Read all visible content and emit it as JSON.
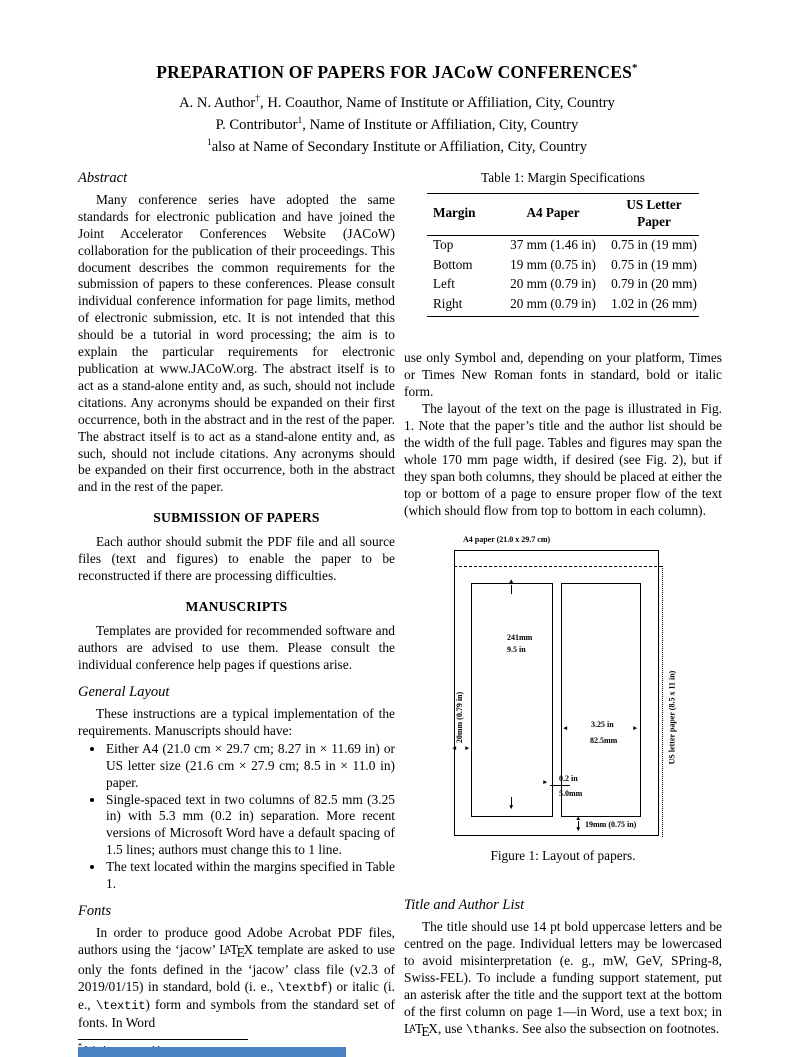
{
  "title": {
    "text": "PREPARATION OF PAPERS FOR JACoW CONFERENCES",
    "footnote_marker": "*"
  },
  "authors": {
    "line1": {
      "pre": "A. N. Author",
      "sup": "†",
      "post": ", H. Coauthor, Name of Institute or Affiliation, City, Country"
    },
    "line2": {
      "pre": "P. Contributor",
      "sup": "1",
      "post": ", Name of Institute or Affiliation, City, Country"
    },
    "line3": {
      "sup": "1",
      "post": "also at Name of Secondary Institute or Affiliation, City, Country"
    }
  },
  "latex_logo": {
    "L": "L",
    "A": "A",
    "T": "T",
    "E": "E",
    "X": "X"
  },
  "left_column": {
    "abstract": {
      "heading": "Abstract",
      "body": "Many conference series have adopted the same standards for electronic publication and have joined the Joint Accelerator Conferences Website (JACoW) collaboration for the publication of their proceedings. This document describes the common requirements for the submission of papers to these conferences. Please consult individual conference information for page limits, method of electronic submission, etc. It is not intended that this should be a tutorial in word processing; the aim is to explain the particular requirements for electronic publication at www.JACoW.org. The abstract itself is to act as a stand-alone entity and, as such, should not include citations. Any acronyms should be expanded on their first occurrence, both in the abstract and in the rest of the paper. The abstract itself is to act as a stand-alone entity and, as such, should not include citations. Any acronyms should be expanded on their first occurrence, both in the abstract and in the rest of the paper."
    },
    "submission": {
      "heading": "SUBMISSION OF PAPERS",
      "body": "Each author should submit the PDF file and all source files (text and figures) to enable the paper to be reconstructed if there are processing difficulties."
    },
    "manuscripts": {
      "heading": "MANUSCRIPTS",
      "body": "Templates are provided for recommended software and authors are advised to use them. Please consult the individual conference help pages if questions arise."
    },
    "general_layout": {
      "heading": "General Layout",
      "intro": "These instructions are a typical implementation of the requirements. Manuscripts should have:",
      "bullets": [
        "Either A4 (21.0 cm × 29.7 cm; 8.27 in × 11.69 in) or US letter size (21.6 cm × 27.9 cm; 8.5 in × 11.0 in) paper.",
        "Single-spaced text in two columns of 82.5 mm (3.25 in) with 5.3 mm (0.2 in) separation. More recent versions of Microsoft Word have a default spacing of 1.5 lines; authors must change this to 1 line.",
        "The text located within the margins specified in Table 1."
      ]
    },
    "fonts": {
      "heading": "Fonts",
      "p_start": "In order to produce good Adobe Acrobat PDF files, authors using the ‘jacow’ ",
      "p_after_latex": " template are asked to use only the fonts defined in the ‘jacow’ class file (v2.3 of 2019/01/15) in standard, bold (i. e., ",
      "code_bold": "\\textbf",
      "p_mid": ") or italic (i. e., ",
      "code_italic": "\\textit",
      "p_end": ") form and symbols from the standard set of fonts. In Word"
    },
    "footnotes": {
      "star_marker": "*",
      "star_text": "Work supported by ...",
      "dagger_marker": "†",
      "dagger_text": "email address"
    }
  },
  "right_column": {
    "table": {
      "caption": "Table 1: Margin Specifications",
      "headers": [
        "Margin",
        "A4 Paper",
        "US Letter Paper"
      ],
      "rows": [
        [
          "Top",
          "37 mm (1.46 in)",
          "0.75 in (19 mm)"
        ],
        [
          "Bottom",
          "19 mm (0.75 in)",
          "0.75 in (19 mm)"
        ],
        [
          "Left",
          "20 mm (0.79 in)",
          "0.79 in (20 mm)"
        ],
        [
          "Right",
          "20 mm (0.79 in)",
          "1.02 in (26 mm)"
        ]
      ]
    },
    "paragraph_fonts_cont": "use only Symbol and, depending on your platform, Times or Times New Roman fonts in standard, bold or italic form.",
    "paragraph_layout": "The layout of the text on the page is illustrated in Fig. 1. Note that the paper’s title and the author list should be the width of the full page. Tables and figures may span the whole 170 mm page width, if desired (see Fig. 2), but if they span both columns, they should be placed at either the top or bottom of a page to ensure proper flow of the text (which should flow from top to bottom in each column).",
    "figure": {
      "caption": "Figure 1: Layout of papers.",
      "labels": {
        "a4_paper": "A4 paper (21.0 x 29.7 cm)",
        "us_letter": "US letter paper (8.5 x 11 in)",
        "col_height_mm": "241mm",
        "col_height_in": "9.5 in",
        "left_margin": "20mm (0.79 in)",
        "col_width_in": "3.25 in",
        "col_width_mm": "82.5mm",
        "gap_in": "0.2 in",
        "gap_mm": "5.0mm",
        "bottom_margin": "19mm (0.75 in)"
      }
    },
    "title_author_list": {
      "heading": "Title and Author List",
      "p_start": "The title should use 14 pt bold uppercase letters and be centred on the page. Individual letters may be lowercased to avoid misinterpretation (e. g., mW, GeV, SPring-8, Swiss-FEL). To include a funding support statement, put an asterisk after the title and the support text at the bottom of the first column on page 1—in Word, use a text box; in ",
      "p_mid": ", use ",
      "code_thanks": "\\thanks",
      "p_end": ". See also the subsection on footnotes."
    }
  },
  "bottom_bar": {
    "color": "#4a80c4"
  }
}
